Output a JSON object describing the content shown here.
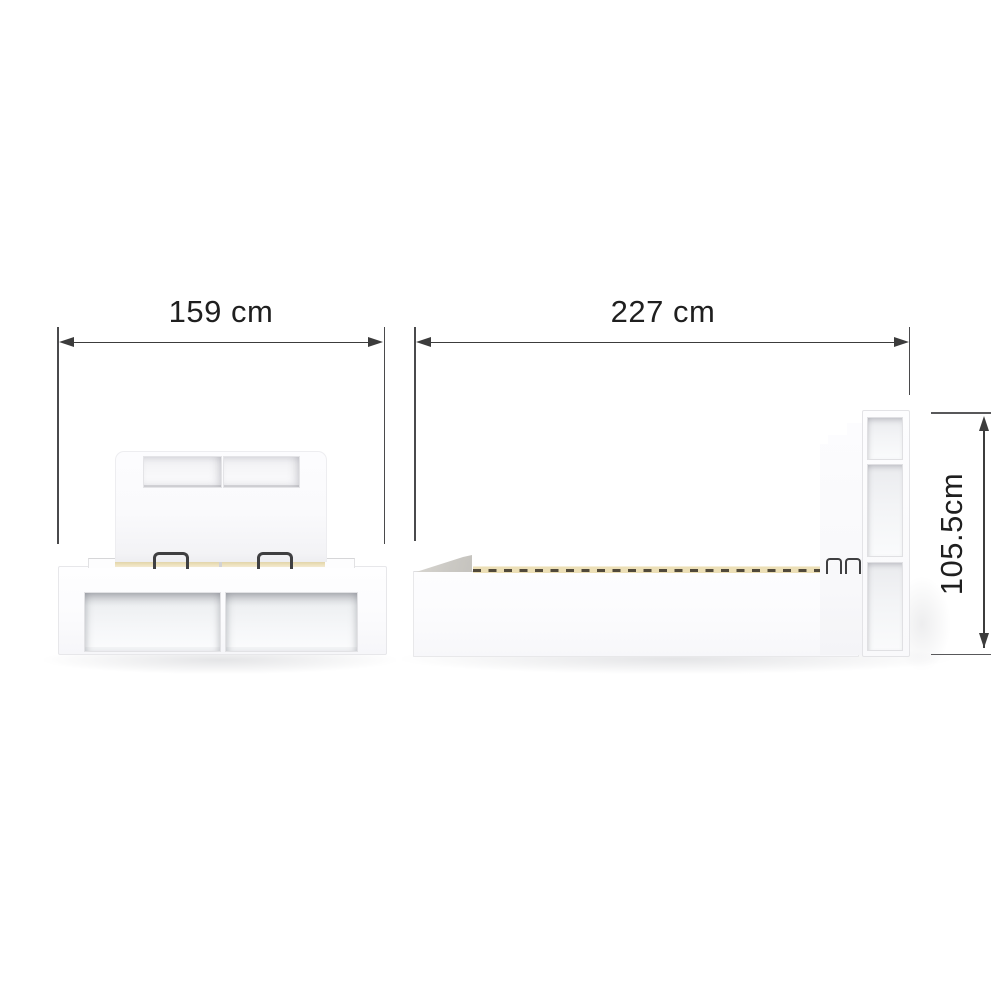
{
  "title": "Storage bed dimension diagram",
  "background_color": "#ffffff",
  "dimensions": {
    "front_width": {
      "label": "159 cm",
      "value_cm": 159,
      "orientation": "horizontal"
    },
    "side_length": {
      "label": "227 cm",
      "value_cm": 227,
      "orientation": "horizontal"
    },
    "height": {
      "label": "105.5cm",
      "value_cm": 105.5,
      "orientation": "vertical-rotated"
    }
  },
  "views": {
    "front": {
      "name": "front view",
      "parts": [
        "headboard with two open niches",
        "two lift-up handles",
        "slat deck edge",
        "storage base with two open compartments"
      ]
    },
    "side": {
      "name": "side view",
      "parts": [
        "angled footboard panel",
        "slatted bed deck",
        "storage base",
        "two lift-up handles",
        "headboard shelf tower with three open shelves"
      ]
    }
  },
  "colors": {
    "furniture_white": "#fbfbfd",
    "recess_gray": "#e9eaed",
    "slat_beige": "#ecdfb6",
    "slat_gap_dark": "#51493a",
    "wedge_gray": "#cbc9c4",
    "handle_dark": "#3f3f41",
    "dimension_line": "#3c3c3c",
    "extension_line": "#4a4a4c",
    "text": "#1f1f1f"
  }
}
